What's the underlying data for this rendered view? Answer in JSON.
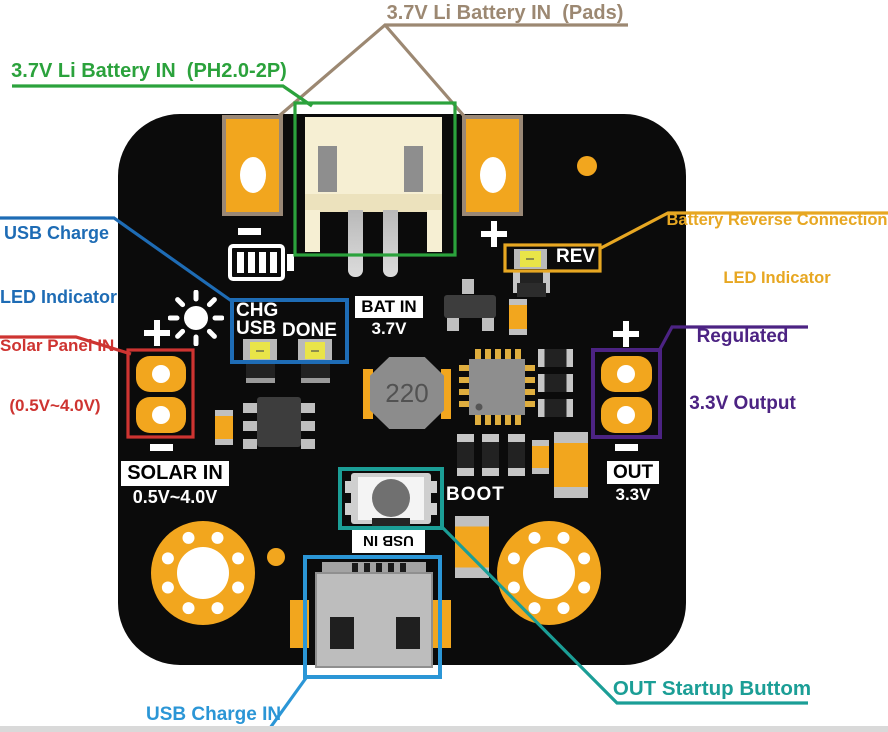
{
  "colors": {
    "taupe": "#9C8872",
    "green": "#2BA23C",
    "blue": "#1E6CB5",
    "red": "#CE3431",
    "amber": "#E7A722",
    "purple": "#4C2383",
    "teal": "#1B9E96",
    "lightblue": "#2B96D6",
    "board": "#0B0B0B",
    "orange": "#F2A61E",
    "tan": "#9A8876",
    "cream": "#F6EFD3",
    "ledyellow": "#E9E448"
  },
  "callouts": {
    "battery_pads": "3.7V Li Battery IN  (Pads)",
    "battery_connector": "3.7V Li Battery IN  (PH2.0-2P)",
    "usb_charge_led_1": "USB Charge",
    "usb_charge_led_2": "LED Indicator",
    "solar_1": "Solar Panel IN",
    "solar_2": "(0.5V~4.0V)",
    "reverse_1": "Battery Reverse Connection",
    "reverse_2": "LED Indicator",
    "regulated_1": "Regulated",
    "regulated_2": "3.3V Output",
    "out_startup": "OUT Startup Buttom",
    "usb_charge_in": "USB Charge IN"
  },
  "silkscreen": {
    "chg": "CHG",
    "usb": "USB",
    "done": "DONE",
    "bat_in": "BAT IN",
    "bat_voltage": "3.7V",
    "rev": "REV",
    "solar_in": "SOLAR IN",
    "solar_voltage": "0.5V~4.0V",
    "out": "OUT",
    "out_voltage": "3.3V",
    "boot": "BOOT",
    "usb_in": "USB IN",
    "inductor_value": "220"
  },
  "symbols": {
    "plus": "+",
    "minus": "−"
  }
}
